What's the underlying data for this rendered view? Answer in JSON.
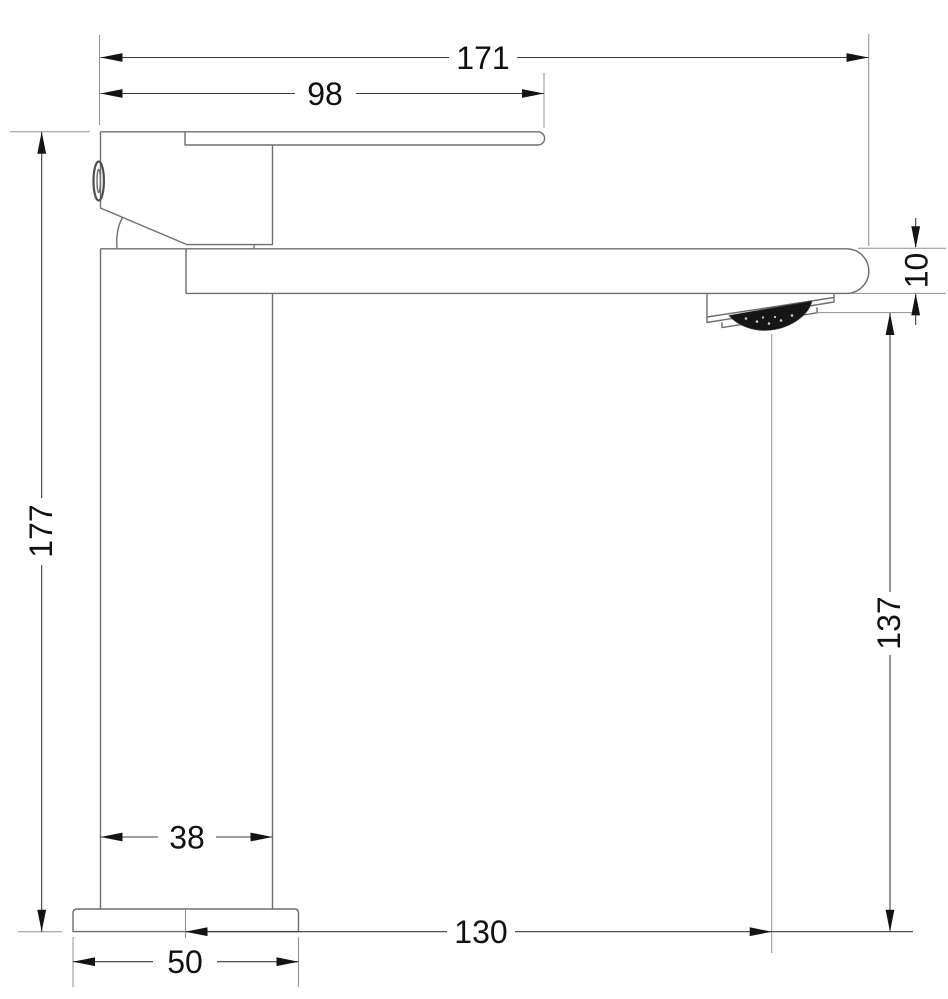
{
  "drawing": {
    "type": "technical-dimension-drawing",
    "subject": "single-lever basin mixer faucet, side elevation",
    "units": "mm",
    "background": "#ffffff"
  },
  "labels": {
    "overall_length": "171",
    "handle_reach": "98",
    "overall_height": "177",
    "spout_thickness": "10",
    "outlet_to_base": "137",
    "column_width": "38",
    "outlet_projection": "130",
    "base_width": "50"
  },
  "colors": {
    "outline": "#6e6e6e",
    "extension_line": "#8f8f8f",
    "dimension_line": "#3c3c3c",
    "arrowhead": "#141414",
    "text": "#111111",
    "aerator_mesh": "#161616"
  }
}
